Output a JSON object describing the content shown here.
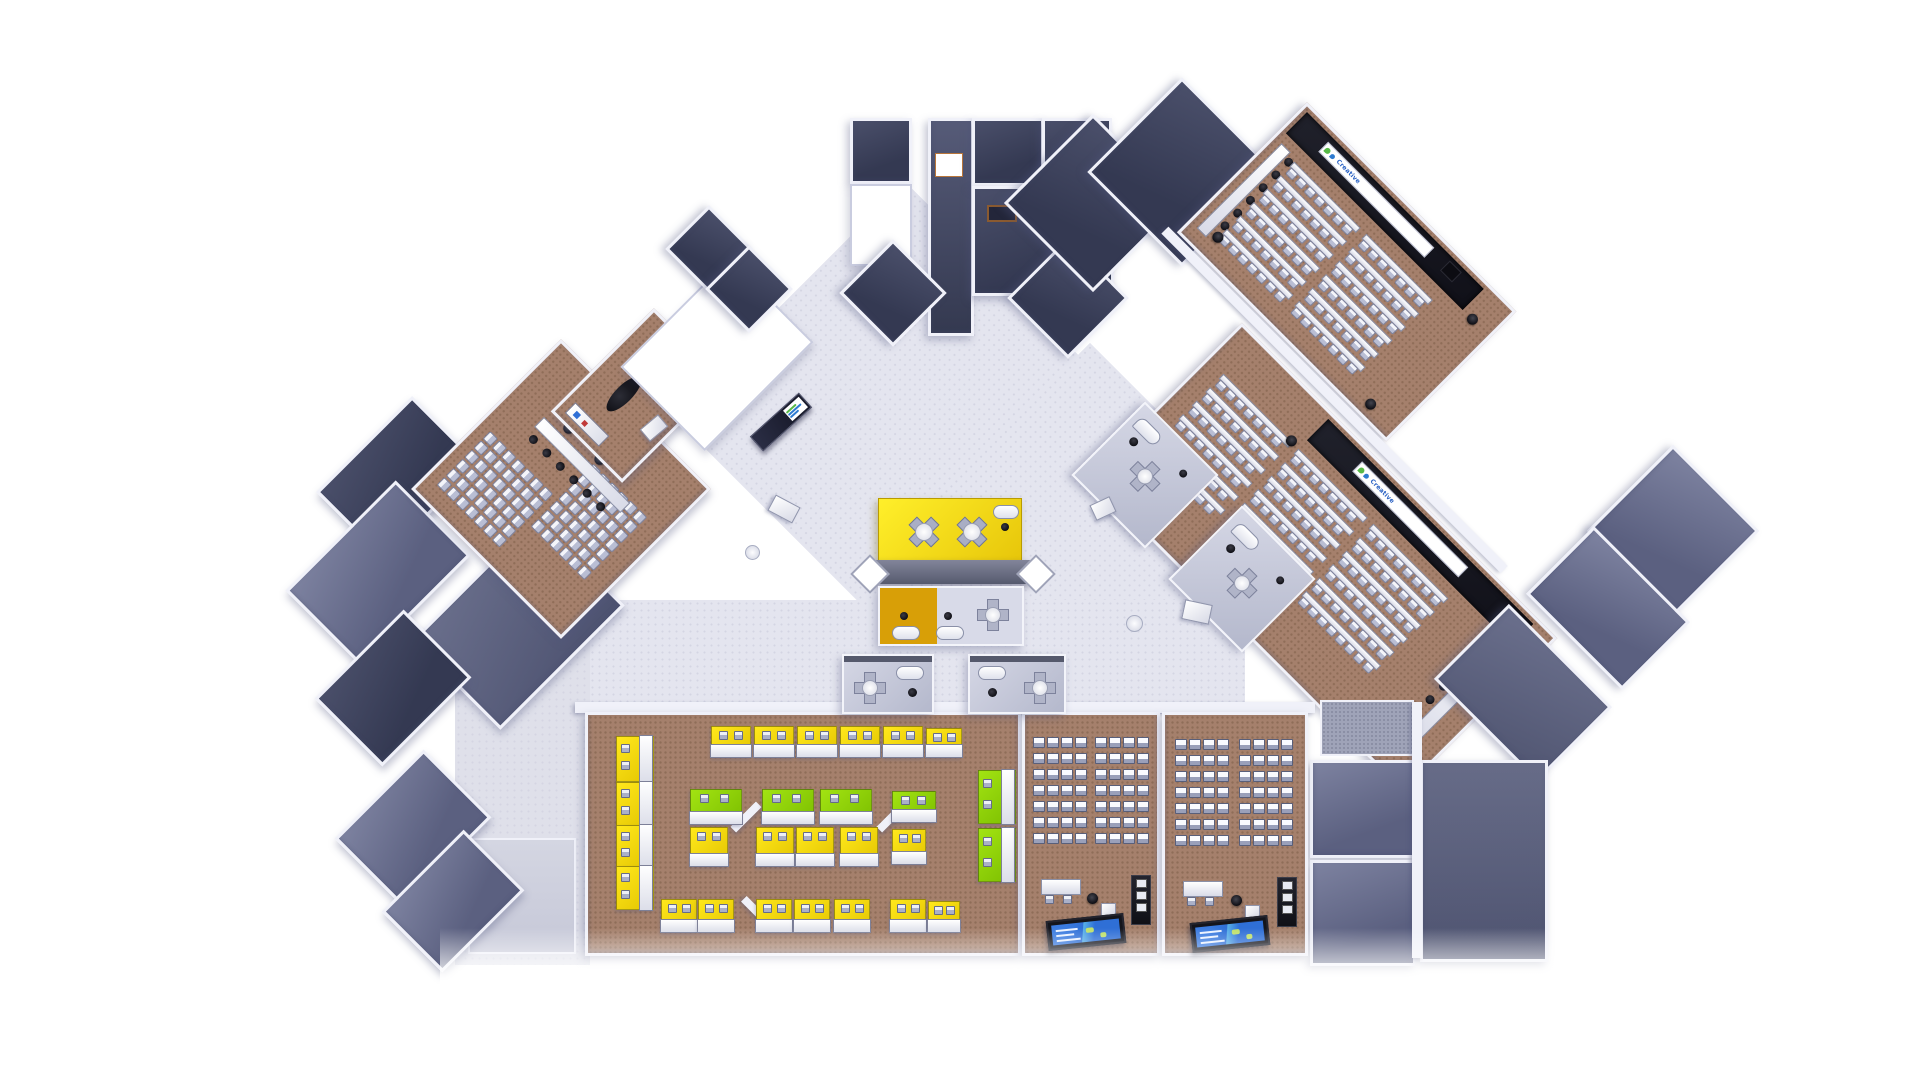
{
  "title": "3D floor plan rendering - learning centre level",
  "banners": {
    "hall1": {
      "text": "Creative",
      "logo": "creative-flower-logo",
      "text_color": "#2a62c4"
    },
    "hall2": {
      "text": "Creative",
      "logo": "creative-flower-logo",
      "text_color": "#2a62c4"
    }
  },
  "colors": {
    "background": "#ffffff",
    "lobbyFloor": "#e4e5ef",
    "carpet": "#a5806c",
    "carpetDark": "#8f6d58",
    "wall": "#f0f1f9",
    "darkRoom": "#3f4460",
    "midRoom": "#6d7290",
    "stage": "#16161d",
    "yellowMat": "#f8dc06",
    "greenMat": "#8fd108",
    "amberPod": "#d49a04",
    "screenBlue": "#2f6fd6",
    "chair": "#b9bed4",
    "kiosk": "#23263b",
    "logoGreen": "#57b947",
    "logoBlue": "#2e7bd0"
  },
  "furniture": {
    "grids": {
      "seminarA": {
        "rows": 7,
        "cols": 6,
        "cw": 13,
        "ch": 13,
        "item": "chairCell",
        "iw": 9,
        "ih": 9
      },
      "seminarB": {
        "rows": 6,
        "cols": 7,
        "cw": 13,
        "ch": 13,
        "item": "chairCell",
        "iw": 9,
        "ih": 9
      },
      "class1a": {
        "rows": 7,
        "cols": 4,
        "cw": 14,
        "ch": 16,
        "item": "mdeskCell",
        "iw": 10,
        "ih": 9
      },
      "class1b": {
        "rows": 7,
        "cols": 4,
        "cw": 14,
        "ch": 16,
        "item": "mdeskCell",
        "iw": 10,
        "ih": 9
      },
      "class2a": {
        "rows": 7,
        "cols": 4,
        "cw": 14,
        "ch": 16,
        "item": "mdeskCell",
        "iw": 10,
        "ih": 9
      },
      "class2b": {
        "rows": 7,
        "cols": 4,
        "cw": 14,
        "ch": 16,
        "item": "mdeskCell",
        "iw": 10,
        "ih": 9
      }
    },
    "hallRows": {
      "hall1": {
        "rows": 6,
        "step": 19,
        "y": 48,
        "segs": [
          [
            30,
            92
          ],
          [
            132,
            92
          ]
        ],
        "chairW": 8,
        "chairGap": 5
      },
      "hall2": {
        "rows": 6,
        "step": 19,
        "y": 46,
        "segs": [
          [
            20,
            96
          ],
          [
            126,
            96
          ],
          [
            232,
            104
          ]
        ],
        "chairW": 8,
        "chairGap": 5
      }
    },
    "dotCols": {
      "hall1side": {
        "n": 6,
        "step": 18
      },
      "hall2head": {
        "n": 6,
        "step": 19
      },
      "seminarHead": {
        "n": 6,
        "step": 19
      }
    },
    "mats": [
      [
        28,
        21,
        36,
        44,
        "y",
        "v"
      ],
      [
        28,
        67,
        36,
        42,
        "y",
        "v"
      ],
      [
        28,
        110,
        36,
        40,
        "y",
        "v"
      ],
      [
        28,
        151,
        36,
        42,
        "y",
        "v"
      ],
      [
        123,
        11,
        38,
        30,
        "y",
        "h"
      ],
      [
        166,
        11,
        38,
        30,
        "y",
        "h"
      ],
      [
        209,
        11,
        38,
        30,
        "y",
        "h"
      ],
      [
        252,
        11,
        38,
        30,
        "y",
        "h"
      ],
      [
        295,
        11,
        38,
        30,
        "y",
        "h"
      ],
      [
        338,
        13,
        34,
        28,
        "y",
        "h"
      ],
      [
        102,
        74,
        50,
        34,
        "g",
        "h"
      ],
      [
        174,
        74,
        50,
        34,
        "g",
        "h"
      ],
      [
        232,
        74,
        50,
        34,
        "g",
        "h"
      ],
      [
        304,
        76,
        42,
        30,
        "g",
        "h"
      ],
      [
        102,
        112,
        36,
        38,
        "y",
        "h"
      ],
      [
        168,
        112,
        36,
        38,
        "y",
        "h"
      ],
      [
        208,
        112,
        36,
        38,
        "y",
        "h"
      ],
      [
        252,
        112,
        36,
        38,
        "y",
        "h"
      ],
      [
        304,
        114,
        32,
        34,
        "y",
        "h"
      ],
      [
        73,
        184,
        34,
        32,
        "y",
        "h"
      ],
      [
        110,
        184,
        34,
        32,
        "y",
        "h"
      ],
      [
        168,
        184,
        34,
        32,
        "y",
        "h"
      ],
      [
        206,
        184,
        34,
        32,
        "y",
        "h"
      ],
      [
        246,
        184,
        34,
        32,
        "y",
        "h"
      ],
      [
        302,
        184,
        34,
        32,
        "y",
        "h"
      ],
      [
        340,
        186,
        30,
        30,
        "y",
        "h"
      ],
      [
        390,
        55,
        36,
        52,
        "g",
        "v"
      ],
      [
        390,
        113,
        36,
        52,
        "g",
        "v"
      ]
    ],
    "screens": {
      "count": 2,
      "content": "blue interactive display with green map blobs"
    }
  },
  "legend": {
    "lecture_halls": 2,
    "computer_classrooms": 2,
    "seminar_room": 1,
    "study_mats_yellow": 20,
    "study_mats_green": 6,
    "breakout_pods": 5
  }
}
